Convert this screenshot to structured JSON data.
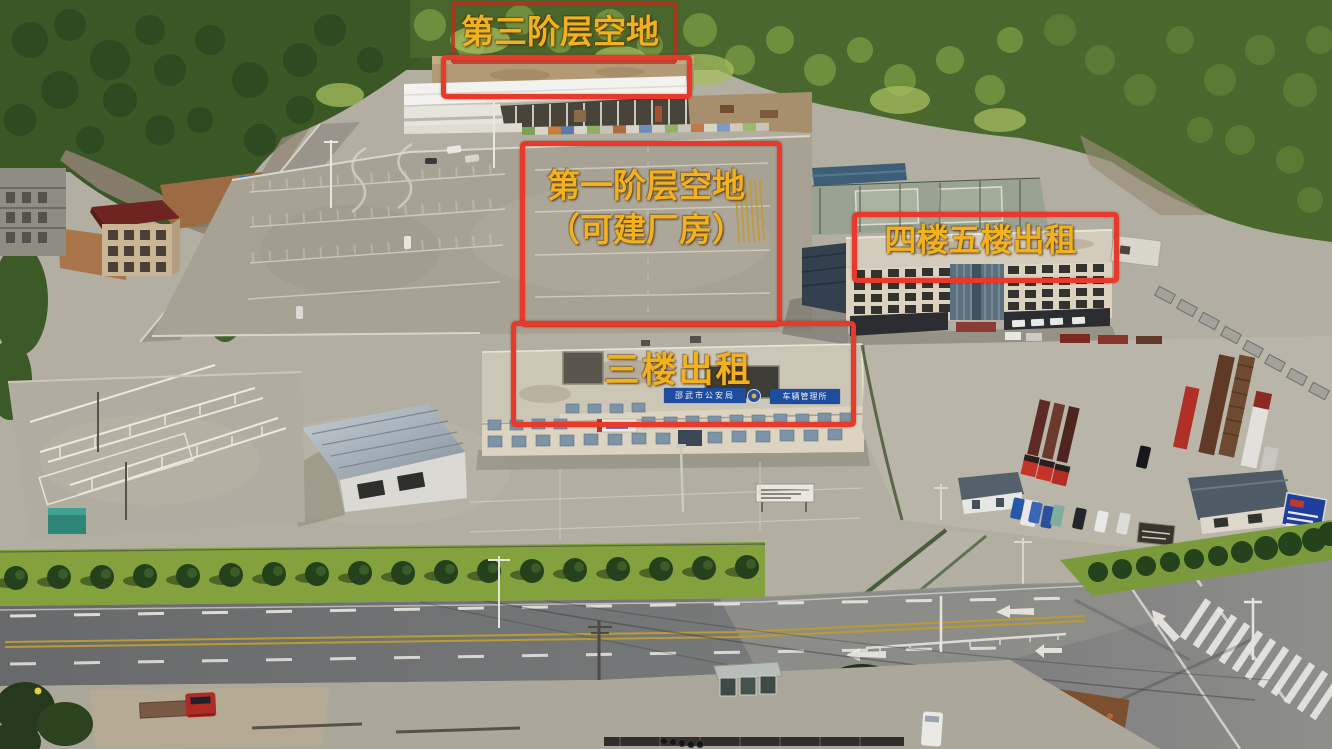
{
  "annotations": {
    "tier3": {
      "label": "第三阶层空地"
    },
    "tier1": {
      "label_line1": "第一阶层空地",
      "label_line2": "（可建厂房）"
    },
    "floors45": {
      "label": "四楼五楼出租"
    },
    "floor3": {
      "label": "三楼出租"
    }
  },
  "signs": {
    "police_bureau": "邵武市公安局",
    "vehicle_office": "车辆管理所"
  },
  "colors": {
    "annotation_text": "#f2b21e",
    "annotation_box": "#e8392b",
    "sign_blue": "#1e4da0"
  }
}
